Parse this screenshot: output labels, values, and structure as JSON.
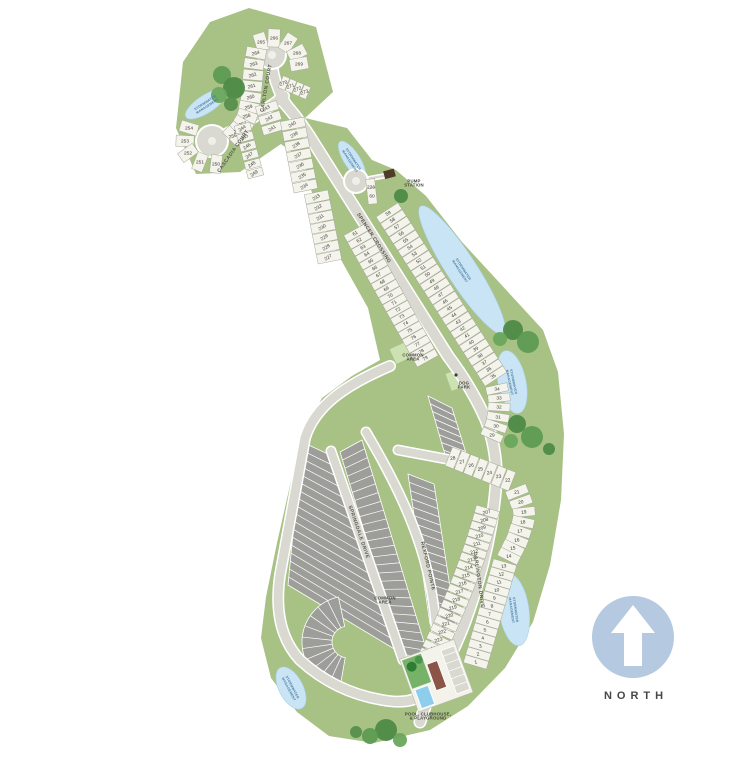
{
  "map": {
    "north_label": "NORTH",
    "streets": {
      "cascadia": "CASCADIA COURT",
      "carlton": "CARLTON COURT",
      "main": "SPENCER CROSSING",
      "springdale": "SPRINGDALE DRIVE",
      "rexford": "REXFORD POINTE",
      "darlington": "DARLINGTON DRIVE"
    },
    "labels": {
      "pump_station": [
        "PUMP",
        "STATION"
      ],
      "dog_park": [
        "DOG",
        "PARK"
      ],
      "common_area": [
        "COMMON",
        "AREA"
      ],
      "pool": [
        "POOL, CLUBHOUSE,",
        "& PLAYGROUND"
      ],
      "pond": [
        "STORMWATER",
        "MANAGEMENT"
      ]
    },
    "lot_groups": {
      "carlton_outer": [
        265,
        266,
        267,
        268,
        269
      ],
      "carlton_right": [
        270,
        271,
        272,
        273
      ],
      "west_arc": [
        264,
        263,
        262,
        261,
        260,
        259,
        258,
        257,
        256,
        255
      ],
      "cascadia_outer": [
        254,
        253,
        252,
        251,
        250
      ],
      "inner_fan": [
        244,
        245,
        246,
        247,
        248,
        249
      ],
      "main_left_a": [
        243,
        242,
        241
      ],
      "main_left_b": [
        240,
        239,
        238,
        237,
        236,
        235,
        234
      ],
      "main_left_c": [
        233,
        232,
        231,
        230,
        229,
        228,
        227
      ],
      "pump_lot": [
        "226",
        "60"
      ],
      "main_left_d": [
        61,
        62,
        63,
        64,
        65,
        66,
        67,
        68,
        69,
        70,
        71,
        72,
        73,
        74,
        75,
        76,
        77,
        78,
        79
      ],
      "main_right": [
        59,
        58,
        57,
        56,
        55,
        54,
        53,
        52,
        51,
        50,
        49,
        48,
        47,
        46,
        45,
        44,
        43,
        42,
        41,
        40,
        39,
        38,
        37,
        36,
        35
      ],
      "curve": [
        34,
        33,
        32,
        31,
        30,
        29
      ],
      "row": [
        28,
        27,
        26,
        25,
        24,
        23,
        22
      ],
      "east_upper": [
        21,
        20,
        19,
        18,
        17,
        16,
        15,
        14
      ],
      "east_lower": [
        13,
        12,
        11,
        10,
        9,
        8,
        7,
        6,
        5,
        4,
        3,
        2,
        1
      ],
      "west_col": [
        207,
        208,
        209,
        210,
        211,
        212,
        213,
        214,
        215,
        216,
        217,
        218,
        219,
        220,
        221,
        222,
        223,
        224,
        225
      ]
    },
    "colors": {
      "land": "#a8c185",
      "pond": "#c9e4f4",
      "road": "#d9d9d2",
      "parcel": "#f4f4ec",
      "townhome": "#9d9d99",
      "compass": "#b5c9e1"
    }
  }
}
